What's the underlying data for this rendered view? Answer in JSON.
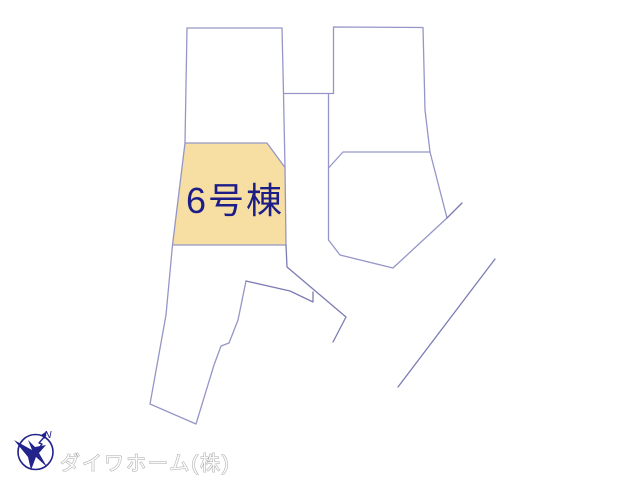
{
  "map": {
    "highlight": {
      "label": "6号棟"
    },
    "colors": {
      "background": "#ffffff",
      "parcel_line": "#9596c7",
      "road_line": "#7b7cb4",
      "highlight_fill": "#f7dfa4",
      "label_text": "#1d1d88"
    }
  },
  "compass": {
    "north_label": "N",
    "color": "#23238c"
  },
  "footer": {
    "company_name": "ダイワホーム(株)",
    "text_color": "#fafafa",
    "outline_color": "#a8a8a8"
  }
}
